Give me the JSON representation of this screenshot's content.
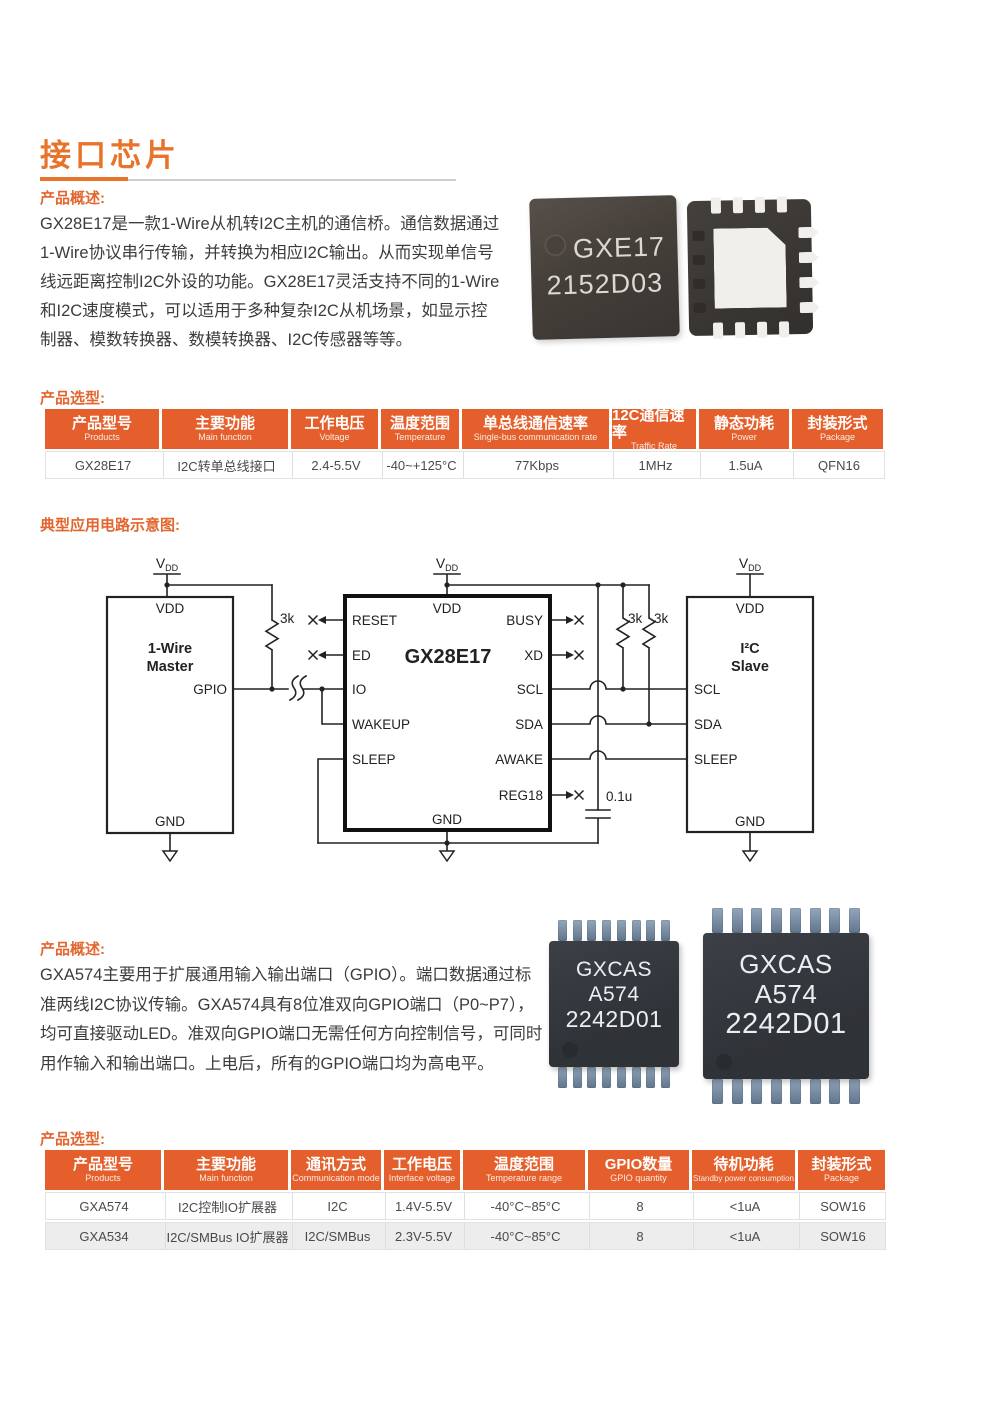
{
  "colors": {
    "accent_orange": "#E8732A",
    "table_header_orange": "#E45F2B",
    "body_text": "#3C3C3C",
    "alt_row_gray": "#EDEDED",
    "chip_lead_blue": "#7A8EA5"
  },
  "header": {
    "title": "接口芯片"
  },
  "section1": {
    "overview_label": "产品概述:",
    "overview_lines": [
      "GX28E17是一款1-Wire从机转I2C主机的通信桥。通信数据通过",
      "1-Wire协议串行传输，并转换为相应I2C输出。从而实现单信号",
      "线远距离控制I2C外设的功能。GX28E17灵活支持不同的1-Wire",
      "和I2C速度模式，可以适用于多种复杂I2C从机场景，如显示控",
      "制器、模数转换器、数模转换器、I2C传感器等等。"
    ],
    "chip_front_marking": [
      "GXE17",
      "2152D03"
    ]
  },
  "table1": {
    "label": "产品选型:",
    "headers": [
      {
        "zh": "产品型号",
        "en": "Products"
      },
      {
        "zh": "主要功能",
        "en": "Main function"
      },
      {
        "zh": "工作电压",
        "en": "Voltage"
      },
      {
        "zh": "温度范围",
        "en": "Temperature"
      },
      {
        "zh": "单总线通信速率",
        "en": "Single-bus communication rate"
      },
      {
        "zh": "12C通信速率",
        "en": "Traffic Rate"
      },
      {
        "zh": "静态功耗",
        "en": "Power"
      },
      {
        "zh": "封装形式",
        "en": "Package"
      }
    ],
    "rows": [
      [
        "GX28E17",
        "I2C转单总线接口",
        "2.4-5.5V",
        "-40~+125°C",
        "77Kbps",
        "1MHz",
        "1.5uA",
        "QFN16"
      ]
    ]
  },
  "circuit": {
    "label": "典型应用电路示意图:",
    "vdd_label": {
      "main": "V",
      "sub": "DD"
    },
    "master": {
      "pin_vdd": "VDD",
      "name1": "1-Wire",
      "name2": "Master",
      "pin_gpio": "GPIO",
      "pin_gnd": "GND"
    },
    "bridge": {
      "name": "GX28E17",
      "pin_vdd": "VDD",
      "pin_gnd": "GND",
      "pins_left": [
        "RESET",
        "ED",
        "IO",
        "WAKEUP",
        "SLEEP"
      ],
      "pins_right": [
        "BUSY",
        "XD",
        "SCL",
        "SDA",
        "AWAKE",
        "REG18"
      ]
    },
    "slave": {
      "pin_vdd": "VDD",
      "name1": "I²C",
      "name2": "Slave",
      "pins_left": [
        "SCL",
        "SDA",
        "SLEEP"
      ],
      "pin_gnd": "GND"
    },
    "resistor1": "3k",
    "resistor2": "3k",
    "resistor3": "3k",
    "capacitor": "0.1u"
  },
  "section2": {
    "overview_label": "产品概述:",
    "overview_lines": [
      "GXA574主要用于扩展通用输入输出端口（GPIO）。端口数据通过标",
      "准两线I2C协议传输。GXA574具有8位准双向GPIO端口（P0~P7），",
      "均可直接驱动LED。准双向GPIO端口无需任何方向控制信号，可同时",
      "用作输入和输出端口。上电后，所有的GPIO端口均为高电平。"
    ],
    "chip_marking": [
      "GXCAS",
      "A574",
      "2242D01"
    ]
  },
  "table2": {
    "label": "产品选型:",
    "headers": [
      {
        "zh": "产品型号",
        "en": "Products"
      },
      {
        "zh": "主要功能",
        "en": "Main function"
      },
      {
        "zh": "通讯方式",
        "en": "Communication mode"
      },
      {
        "zh": "工作电压",
        "en": "Interface voltage"
      },
      {
        "zh": "温度范围",
        "en": "Temperature range"
      },
      {
        "zh": "GPIO数量",
        "en": "GPIO quantity"
      },
      {
        "zh": "待机功耗",
        "en": "Standby power consumption"
      },
      {
        "zh": "封装形式",
        "en": "Package"
      }
    ],
    "rows": [
      [
        "GXA574",
        "I2C控制IO扩展器",
        "I2C",
        "1.4V-5.5V",
        "-40°C~85°C",
        "8",
        "<1uA",
        "SOW16"
      ],
      [
        "GXA534",
        "I2C/SMBus IO扩展器",
        "I2C/SMBus",
        "2.3V-5.5V",
        "-40°C~85°C",
        "8",
        "<1uA",
        "SOW16"
      ]
    ]
  }
}
